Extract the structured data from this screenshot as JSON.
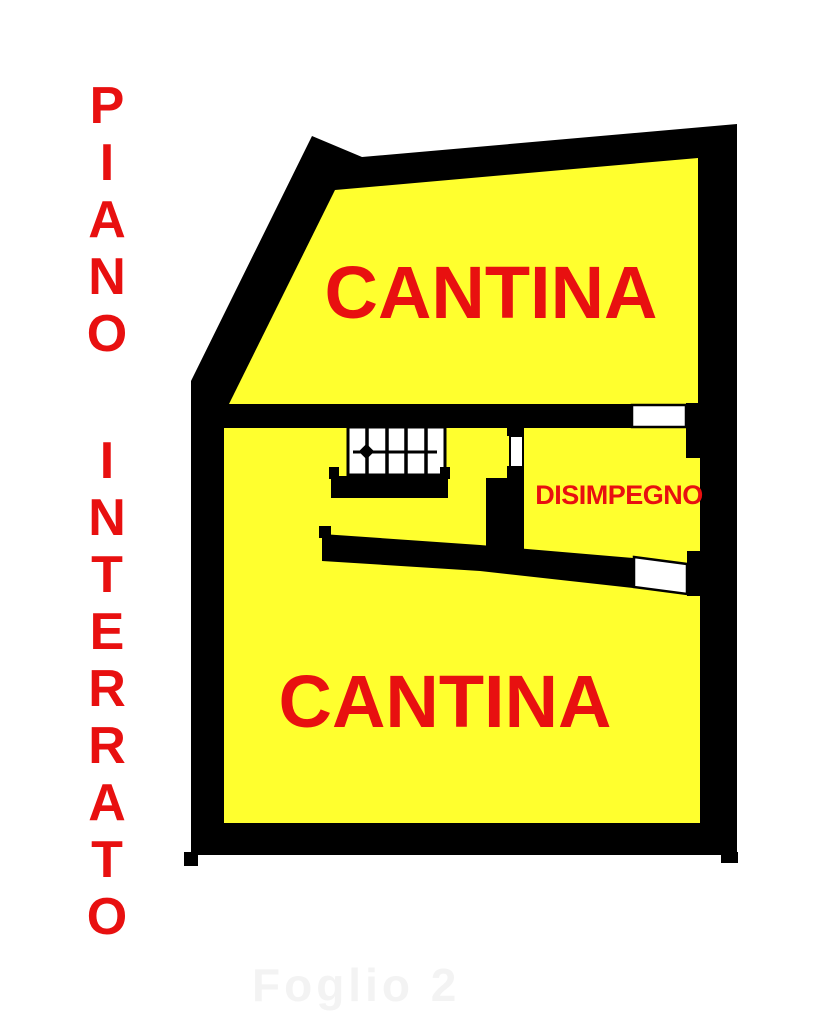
{
  "page": {
    "background_color": "#ffffff"
  },
  "side_label": {
    "text": "PIANO INTERRATO",
    "color": "#e81010"
  },
  "plan": {
    "colors": {
      "wall": "#000000",
      "room_fill": "#ffff2e",
      "label_red": "#e81010",
      "opening_white": "#ffffff"
    },
    "rooms": [
      {
        "id": "cantina-upper",
        "label": "CANTINA"
      },
      {
        "id": "disimpegno",
        "label": "DISIMPEGNO"
      },
      {
        "id": "cantina-lower",
        "label": "CANTINA"
      }
    ]
  },
  "watermark": {
    "text": "Foglio 2",
    "color": "#f3f3f3"
  }
}
